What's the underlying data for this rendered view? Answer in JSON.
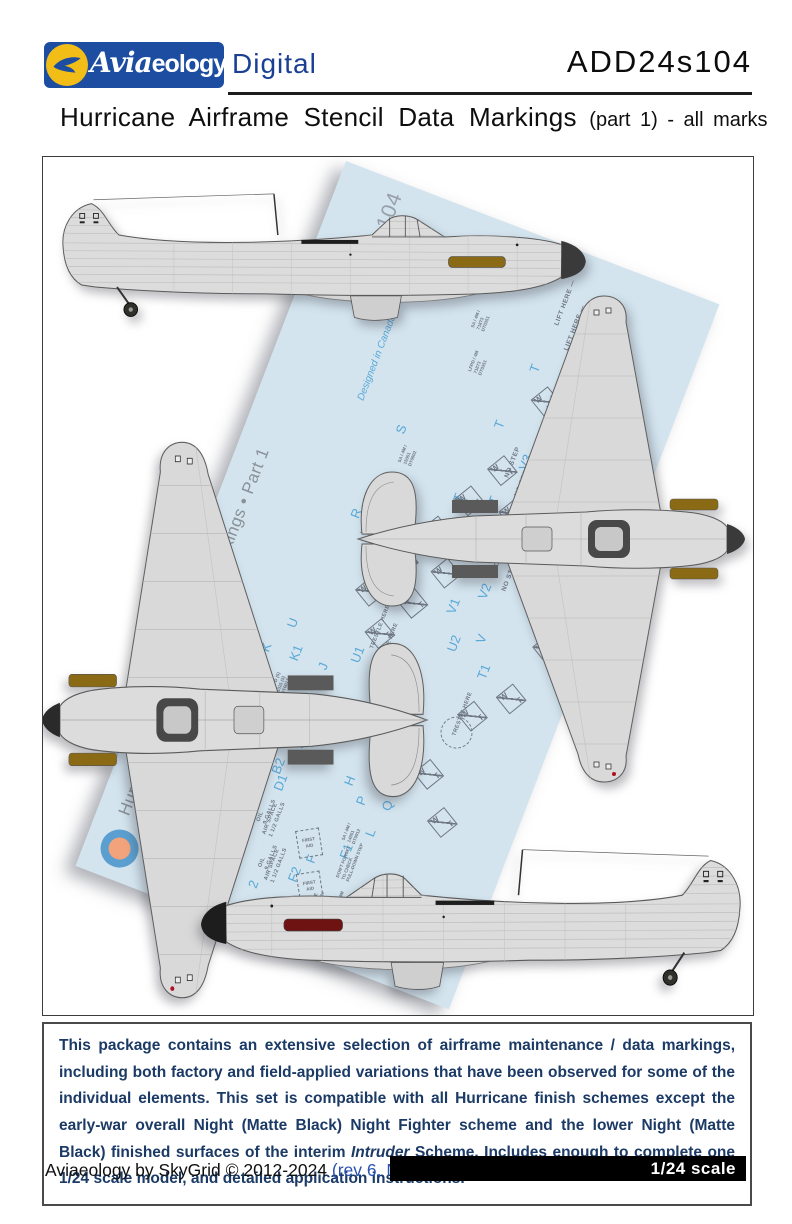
{
  "header": {
    "logo_script": "Avia",
    "logo_rest": "eology",
    "logo_suffix": "Digital",
    "product_code": "ADD24s104"
  },
  "title": {
    "main": "Hurricane Airframe Stencil Data Markings",
    "sub": "(part 1) - all marks"
  },
  "sheet": {
    "title": "Hurricane Airframe Stencil Data Markings • Part 1",
    "copyright": "Copyright ©2010–2024 Aviaeology",
    "designed": "Designed in Canada",
    "code": "ADD24s104",
    "country": "Canada",
    "colors": {
      "paper": "#d3e4ee",
      "ink_blue": "#58a8d8",
      "ink_gray": "#6f7783"
    },
    "wt": {
      "w": "W",
      "t": "T"
    },
    "first_aid": "FIRST\nAID",
    "letters": [
      {
        "t": "X",
        "x": 298,
        "y": 75
      },
      {
        "t": "W",
        "x": 272,
        "y": 158
      },
      {
        "t": "V3",
        "x": 268,
        "y": 225
      },
      {
        "t": "T",
        "x": 243,
        "y": 130
      },
      {
        "t": "T",
        "x": 230,
        "y": 195
      },
      {
        "t": "T",
        "x": 252,
        "y": 268
      },
      {
        "t": "S",
        "x": 140,
        "y": 235
      },
      {
        "t": "T",
        "x": 218,
        "y": 278
      },
      {
        "t": "R",
        "x": 128,
        "y": 330
      },
      {
        "t": "V2",
        "x": 276,
        "y": 360
      },
      {
        "t": "V1",
        "x": 252,
        "y": 385
      },
      {
        "t": "V",
        "x": 290,
        "y": 402
      },
      {
        "t": "U2",
        "x": 266,
        "y": 420
      },
      {
        "t": "T1",
        "x": 304,
        "y": 435
      },
      {
        "t": "U",
        "x": 108,
        "y": 455
      },
      {
        "t": "K",
        "x": 92,
        "y": 487
      },
      {
        "t": "K1",
        "x": 122,
        "y": 485
      },
      {
        "t": "J",
        "x": 152,
        "y": 483
      },
      {
        "t": "U1",
        "x": 180,
        "y": 465
      },
      {
        "t": "Y",
        "x": 268,
        "y": 535
      },
      {
        "t": "N",
        "x": 188,
        "y": 532
      },
      {
        "t": "M",
        "x": 175,
        "y": 550
      },
      {
        "t": "E",
        "x": 158,
        "y": 565
      },
      {
        "t": "H",
        "x": 218,
        "y": 582
      },
      {
        "t": "P",
        "x": 236,
        "y": 596
      },
      {
        "t": "L",
        "x": 256,
        "y": 622
      },
      {
        "t": "Q",
        "x": 262,
        "y": 592
      },
      {
        "t": "B1",
        "x": 132,
        "y": 572
      },
      {
        "t": "B2",
        "x": 146,
        "y": 597
      },
      {
        "t": "D1",
        "x": 154,
        "y": 612
      },
      {
        "t": "C",
        "x": 98,
        "y": 588
      },
      {
        "t": "C1",
        "x": 112,
        "y": 576
      },
      {
        "t": "C2",
        "x": 126,
        "y": 628
      },
      {
        "t": "D",
        "x": 132,
        "y": 662
      },
      {
        "t": "F",
        "x": 210,
        "y": 668
      },
      {
        "t": "F1",
        "x": 240,
        "y": 652
      },
      {
        "t": "F2",
        "x": 200,
        "y": 692
      },
      {
        "t": "2",
        "x": 165,
        "y": 712
      }
    ],
    "stencils": [
      {
        "t": "NO STEP",
        "cls": "s-big",
        "x": 260,
        "y": 238
      },
      {
        "t": "NO STEP",
        "cls": "s-big",
        "x": 276,
        "y": 252
      },
      {
        "t": "NO STEP",
        "cls": "s-big",
        "x": 292,
        "y": 268
      },
      {
        "t": "NO STEP",
        "cls": "s-big",
        "x": 266,
        "y": 315
      },
      {
        "t": "NO STEP",
        "cls": "s-big",
        "x": 282,
        "y": 330
      },
      {
        "t": "NO STEP",
        "cls": "s-big",
        "x": 298,
        "y": 345
      },
      {
        "t": "LIFT HERE —",
        "cls": "s-big",
        "x": 252,
        "y": 78
      },
      {
        "t": "LIFT HERE —",
        "cls": "s-big",
        "x": 270,
        "y": 98
      },
      {
        "t": "TRESTLE HERE",
        "cls": "s-mid",
        "x": 196,
        "y": 446
      },
      {
        "t": "TRESTLE HERE",
        "cls": "s-mid",
        "x": 210,
        "y": 460
      },
      {
        "t": "TRESTLE HERE",
        "cls": "s-mid",
        "x": 236,
        "y": 515
      },
      {
        "t": "TRESTLE HERE",
        "cls": "s-mid",
        "x": 304,
        "y": 498
      },
      {
        "t": "TRESTLE HERE",
        "cls": "s-mid",
        "x": 250,
        "y": 545
      },
      {
        "t": "OIL\n9 GALLS",
        "cls": "s-mid",
        "x": 152,
        "y": 648
      },
      {
        "t": "OIL\n9 GALLS",
        "cls": "s-mid",
        "x": 170,
        "y": 690
      },
      {
        "t": "AIR SPACE\n1 1/2 GALLS",
        "cls": "s-mid",
        "x": 162,
        "y": 658
      },
      {
        "t": "AIR SPACE\n1 1/2 GALLS",
        "cls": "s-mid",
        "x": 180,
        "y": 700
      },
      {
        "t": "COOLANT MIXTURE\nGLYCOL, WATER 70%",
        "cls": "s-tiny",
        "x": 232,
        "y": 738
      },
      {
        "t": "DON'T FORGET\nTO CHECK\nPULL-DOWN STEP",
        "cls": "s-tiny",
        "x": 246,
        "y": 672
      },
      {
        "t": "IS YOUR OXYGEN\nCYLINDER TURNED ON",
        "cls": "s-tiny",
        "x": 100,
        "y": 556
      },
      {
        "t": "IS YOUR OXYGEN\nCYLINDER TURNED ON",
        "cls": "s-tiny",
        "x": 84,
        "y": 700
      },
      {
        "t": "5A / 4M /\n71873\nDT0351",
        "cls": "s-tiny",
        "x": 175,
        "y": 110
      },
      {
        "t": "LFPD / 4M\n71873\nDT0351",
        "cls": "s-tiny",
        "x": 188,
        "y": 152
      },
      {
        "t": "5A / 4M /\n15051\nDT0902",
        "cls": "s-tiny",
        "x": 155,
        "y": 262
      },
      {
        "t": "LFPD / 4M\n173208\nDT0912",
        "cls": "s-tiny",
        "x": 145,
        "y": 342
      },
      {
        "t": "5A / 4M /\n14051\nDT0912",
        "cls": "s-tiny",
        "x": 238,
        "y": 635
      },
      {
        "t": "LFPD (5)\n1025 (5)\nDT0017",
        "cls": "s-tiny",
        "x": 118,
        "y": 520
      },
      {
        "t": "LFPD / 4M\n71873\nDT0351",
        "cls": "s-tiny",
        "x": 256,
        "y": 705
      }
    ],
    "wt_boxes": [
      {
        "x": 305,
        "y": 110
      },
      {
        "x": 262,
        "y": 142
      },
      {
        "x": 290,
        "y": 188
      },
      {
        "x": 246,
        "y": 222
      },
      {
        "x": 272,
        "y": 258
      },
      {
        "x": 226,
        "y": 262
      },
      {
        "x": 250,
        "y": 298
      },
      {
        "x": 206,
        "y": 302
      },
      {
        "x": 230,
        "y": 338
      },
      {
        "x": 186,
        "y": 342
      },
      {
        "x": 210,
        "y": 378
      },
      {
        "x": 166,
        "y": 382
      },
      {
        "x": 190,
        "y": 418
      },
      {
        "x": 306,
        "y": 462
      },
      {
        "x": 286,
        "y": 532
      },
      {
        "x": 316,
        "y": 572
      },
      {
        "x": 336,
        "y": 432
      },
      {
        "x": 352,
        "y": 372
      }
    ],
    "aid_boxes": [
      {
        "x": 198,
        "y": 636
      },
      {
        "x": 214,
        "y": 676
      },
      {
        "x": 220,
        "y": 716
      }
    ],
    "circle": {
      "x": 292,
      "y": 478
    }
  },
  "description": {
    "part1": "This package contains an extensive selection of airframe maintenance / data markings, including both factory and field-applied variations that have been observed for some of the individual elements. This set is compatible with all Hurricane finish schemes except the early-war overall Night (Matte Black) Night Fighter scheme and the lower Night (Matte Black) finished surfaces of the interim ",
    "italic": "Intruder",
    "part2": " Scheme. Includes enough to complete one 1/24 scale model, and detailed application instructions."
  },
  "footer": {
    "credit": "Aviaeology by SkyGrid © 2012-2024 ",
    "revision": "(rev 6, November 2024)",
    "scale_label": "1/24 scale"
  }
}
